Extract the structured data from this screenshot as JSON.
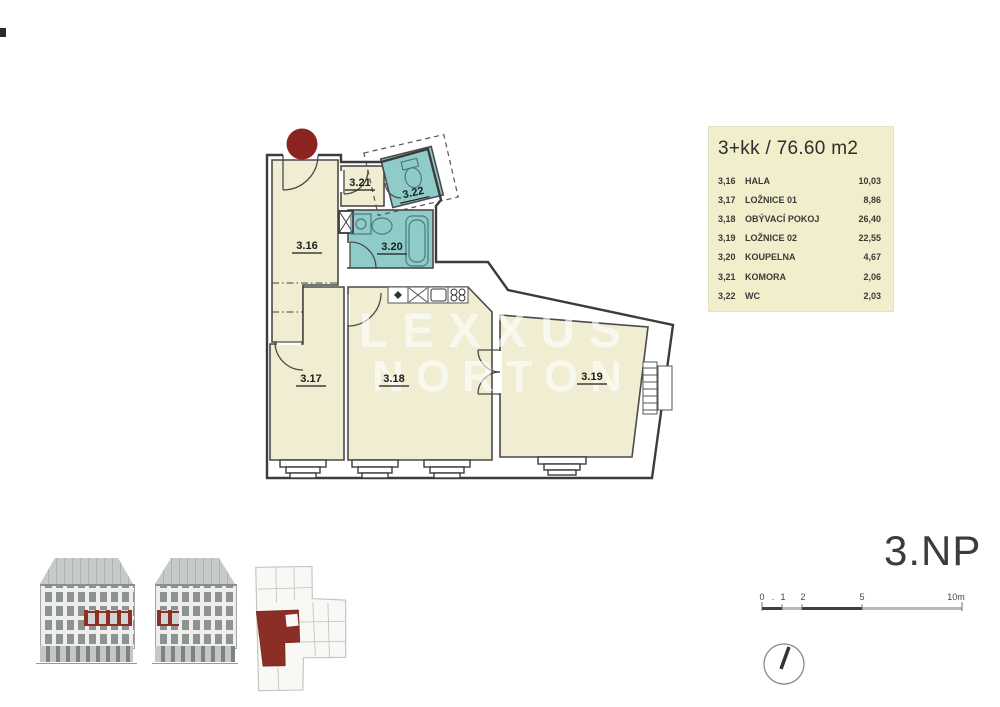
{
  "colors": {
    "unit_red": "#8b2e26",
    "wet_room_teal": "#8fccc9",
    "room_cream": "#f0edd2",
    "legend_bg": "#f1eecb"
  },
  "legend": {
    "title": "3+kk / 76.60 m2",
    "rows": [
      {
        "num": "3,16",
        "name": "HALA",
        "area": "10,03"
      },
      {
        "num": "3,17",
        "name": "LOŽNICE 01",
        "area": "8,86"
      },
      {
        "num": "3,18",
        "name": "OBÝVACÍ POKOJ",
        "area": "26,40"
      },
      {
        "num": "3,19",
        "name": "LOŽNICE 02",
        "area": "22,55"
      },
      {
        "num": "3,20",
        "name": "KOUPELNA",
        "area": "4,67"
      },
      {
        "num": "3,21",
        "name": "KOMORA",
        "area": "2,06"
      },
      {
        "num": "3,22",
        "name": "WC",
        "area": "2,03"
      }
    ]
  },
  "plan": {
    "watermark": {
      "line1": "LEXXUS",
      "line2": "NORTON"
    },
    "labels": {
      "hala": "3.16",
      "loznice01": "3.17",
      "obyvaci_pokoj": "3.18",
      "loznice02": "3.19",
      "koupelna": "3.20",
      "komora": "3.21",
      "wc": "3.22"
    }
  },
  "floor": {
    "label": "3.NP"
  },
  "scalebar": {
    "ticks": [
      "0",
      ".",
      "1",
      "2",
      "5",
      "10m"
    ]
  }
}
